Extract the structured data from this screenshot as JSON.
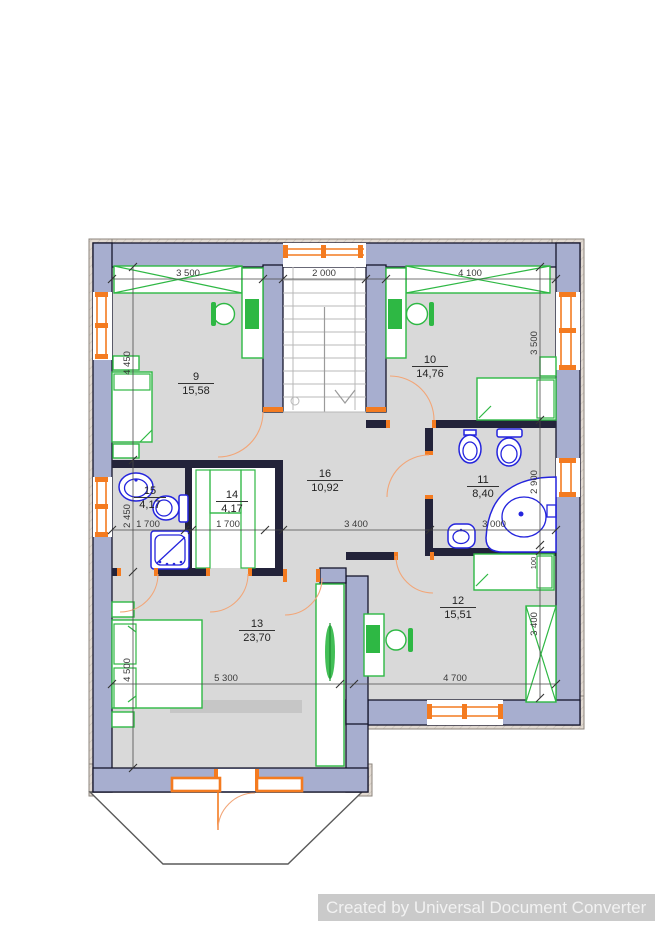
{
  "watermark": "Created by Universal Document Converter",
  "rooms": {
    "r9": {
      "number": "9",
      "area": "15,58"
    },
    "r10": {
      "number": "10",
      "area": "14,76"
    },
    "r11": {
      "number": "11",
      "area": "8,40"
    },
    "r12": {
      "number": "12",
      "area": "15,51"
    },
    "r13": {
      "number": "13",
      "area": "23,70"
    },
    "r14": {
      "number": "14",
      "area": "4,17"
    },
    "r15": {
      "number": "15",
      "area": "4,17"
    },
    "r16": {
      "number": "16",
      "area": "10,92"
    }
  },
  "dimensions": {
    "top": [
      "3 500",
      "2 000",
      "4 100"
    ],
    "left": [
      "4 450",
      "2 450",
      "4 500"
    ],
    "right": [
      "3 500",
      "2 900",
      "100",
      "3 400"
    ],
    "middle": [
      "1 700",
      "1 700",
      "3 400",
      "3 000"
    ],
    "bottom": [
      "5 300",
      "4 700"
    ]
  },
  "colors": {
    "wall_fill": "#a7aecf",
    "wall_outline": "#16162c",
    "floor": "#d9d9d9",
    "furniture_green": "#2eb844",
    "plumbing_blue": "#2424dd",
    "openings_orange": "#f47b20",
    "trim_beige": "#e2dad2",
    "watermark_bg": "#cacaca",
    "watermark_text": "#f2f2f2"
  }
}
